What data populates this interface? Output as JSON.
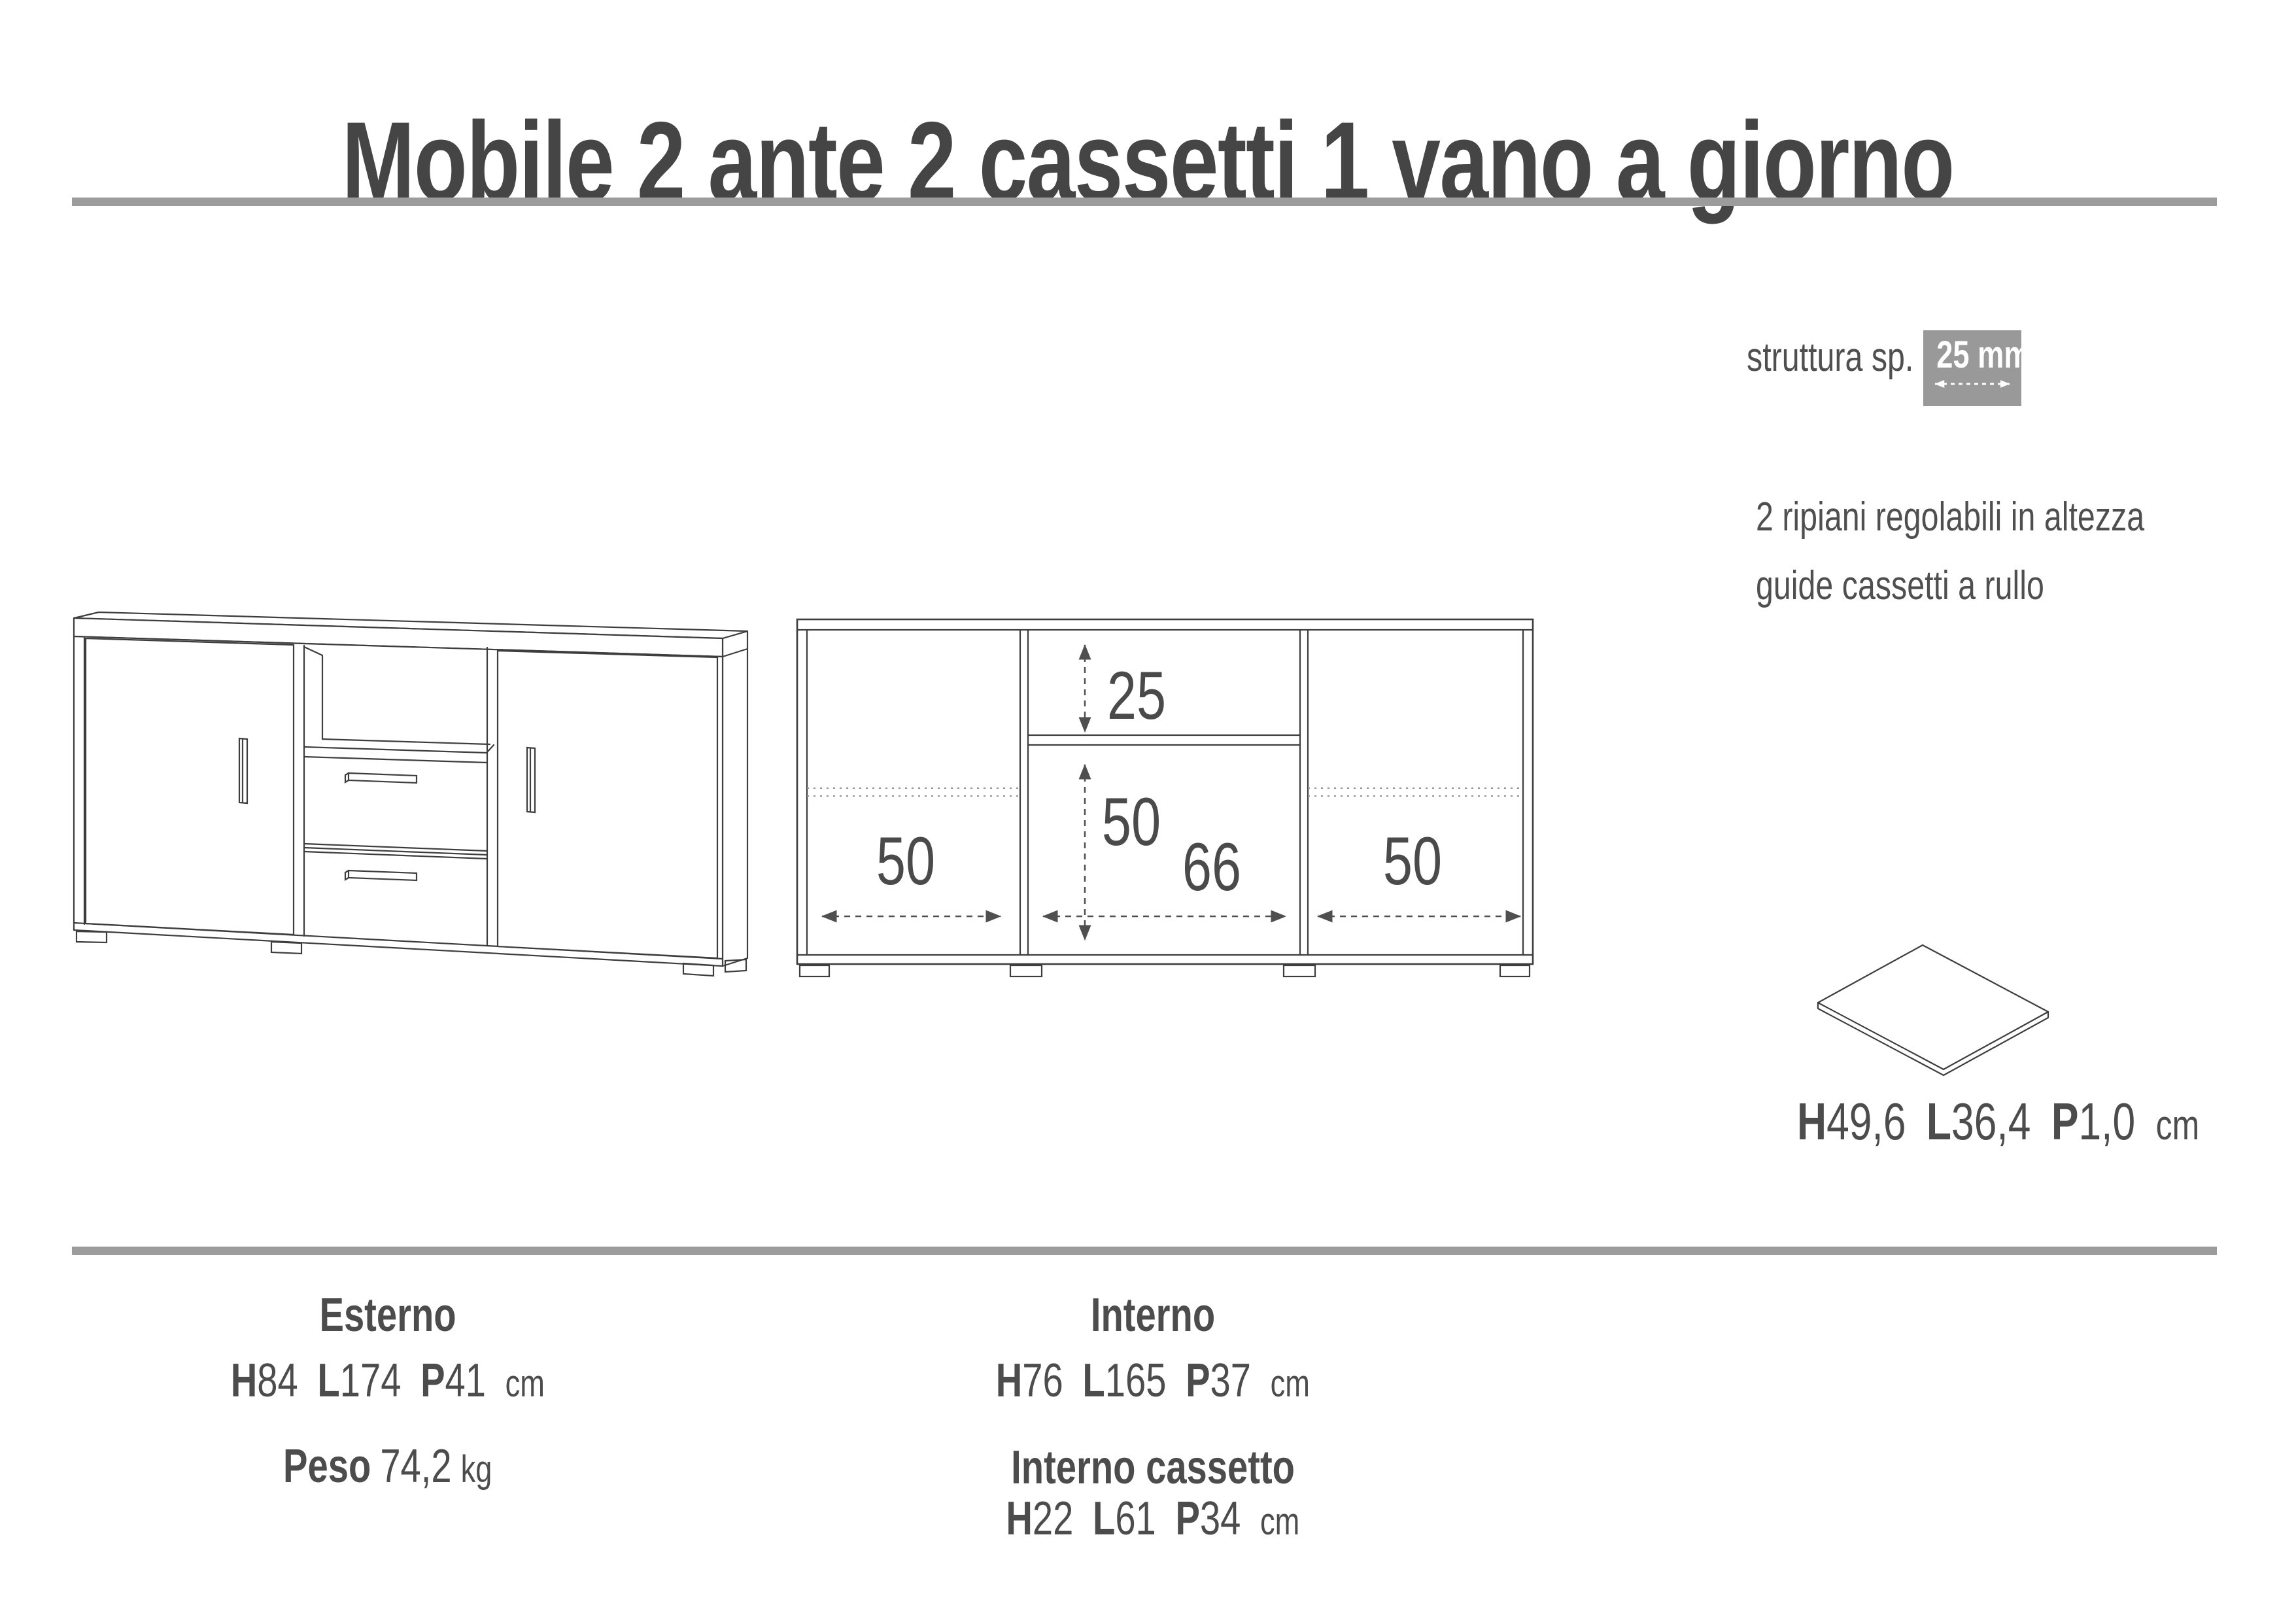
{
  "title": "Mobile 2 ante 2 cassetti 1 vano a giorno",
  "structure": {
    "label": "struttura sp.",
    "value": "25 mm"
  },
  "features": [
    "2 ripiani regolabili in altezza",
    "guide cassetti a rullo"
  ],
  "front_view": {
    "vano_height": "25",
    "inner_height": "50",
    "left_width": "50",
    "center_width": "66",
    "right_width": "50"
  },
  "shelf_panel": {
    "h_label": "H",
    "h": "49,6",
    "l_label": "L",
    "l": "36,4",
    "p_label": "P",
    "p": "1,0",
    "unit": "cm"
  },
  "specs": {
    "esterno": {
      "title": "Esterno",
      "h_label": "H",
      "h": "84",
      "l_label": "L",
      "l": "174",
      "p_label": "P",
      "p": "41",
      "unit": "cm",
      "peso_label": "Peso",
      "peso_value": "74,2",
      "peso_unit": "kg"
    },
    "interno": {
      "title": "Interno",
      "h_label": "H",
      "h": "76",
      "l_label": "L",
      "l": "165",
      "p_label": "P",
      "p": "37",
      "unit": "cm"
    },
    "interno_cassetto": {
      "title": "Interno cassetto",
      "h_label": "H",
      "h": "22",
      "l_label": "L",
      "l": "61",
      "p_label": "P",
      "p": "34",
      "unit": "cm"
    }
  }
}
